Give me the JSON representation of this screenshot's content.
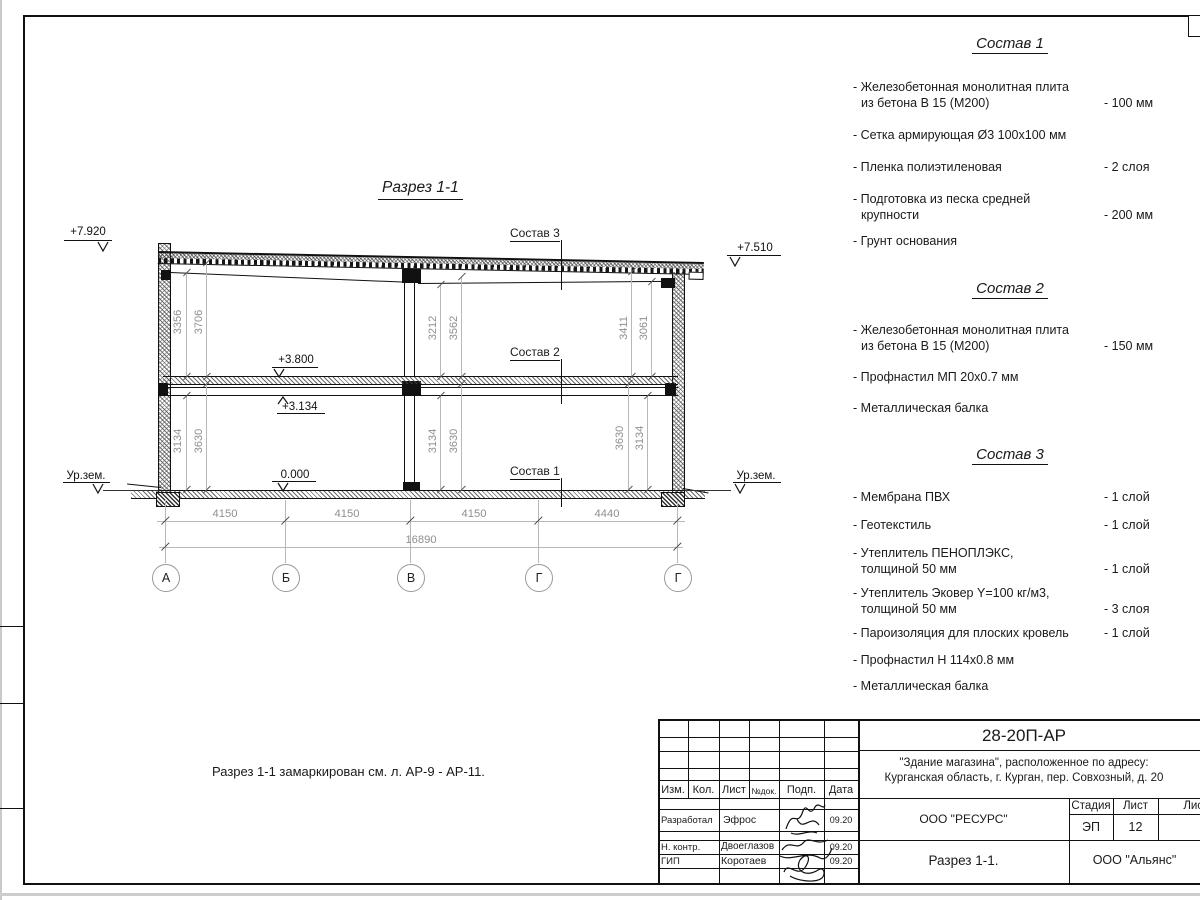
{
  "drawing": {
    "title": "Разрез 1-1",
    "note": "Разрез 1-1 замаркирован см. л. АР-9 - АР-11.",
    "ground_left": "Ур.зем.",
    "ground_right": "Ур.зем.",
    "levels": {
      "roof_left": "+7.920",
      "roof_right": "+7.510",
      "floor2": "+3.800",
      "beam2": "+3.134",
      "floor1": "0.000"
    },
    "callouts": [
      "Состав 3",
      "Состав 2",
      "Состав 1"
    ],
    "axes": [
      "А",
      "Б",
      "В",
      "Г",
      "Г"
    ],
    "dims_bottom": [
      "4150",
      "4150",
      "4150",
      "4440"
    ],
    "dim_total": "16890",
    "vdims": [
      "3356",
      "3706",
      "3212",
      "3562",
      "3411",
      "3061",
      "3134",
      "3630",
      "3134",
      "3630",
      "3630",
      "3134"
    ]
  },
  "specs": [
    {
      "title": "Состав 1",
      "items": [
        {
          "line1": "- Железобетонная  монолитная плита",
          "line2": "из бетона В 15 (М200)",
          "value": "- 100 мм"
        },
        {
          "line1": "- Сетка армирующая Ø3 100x100 мм",
          "line2": "",
          "value": ""
        },
        {
          "line1": "- Пленка полиэтиленовая",
          "line2": "",
          "value": "-  2 слоя"
        },
        {
          "line1": "- Подготовка из песка средней",
          "line2": "крупности",
          "value": "- 200 мм"
        },
        {
          "line1": "- Грунт основания",
          "line2": "",
          "value": ""
        }
      ]
    },
    {
      "title": "Состав 2",
      "items": [
        {
          "line1": "- Железобетонная  монолитная плита",
          "line2": "из бетона В 15 (М200)",
          "value": "- 150 мм"
        },
        {
          "line1": "- Профнастил МП 20x0.7 мм",
          "line2": "",
          "value": ""
        },
        {
          "line1": "- Металлическая балка",
          "line2": "",
          "value": ""
        }
      ]
    },
    {
      "title": "Состав 3",
      "items": [
        {
          "line1": "- Мембрана ПВХ",
          "line2": "",
          "value": "- 1 слой"
        },
        {
          "line1": "- Геотекстиль",
          "line2": "",
          "value": "- 1 слой"
        },
        {
          "line1": "- Утеплитель ПЕНОПЛЭКС,",
          "line2": "толщиной 50 мм",
          "value": "- 1 слой"
        },
        {
          "line1": "- Утеплитель Эковер Y=100 кг/м3,",
          "line2": "толщиной 50 мм",
          "value": "- 3 слоя"
        },
        {
          "line1": "- Пароизоляция для плоских кровель",
          "line2": "",
          "value": "- 1 слой"
        },
        {
          "line1": "- Профнастил Н 114x0.8 мм",
          "line2": "",
          "value": ""
        },
        {
          "line1": "- Металлическая балка",
          "line2": "",
          "value": ""
        }
      ]
    }
  ],
  "titleblock": {
    "doc_code": "28-20П-АР",
    "object_line1": "\"Здание магазина\", расположенное по адресу:",
    "object_line2": "Курганская область, г. Курган, пер. Совхозный, д. 20",
    "org_customer": "ООО \"РЕСУРС\"",
    "org_contractor": "ООО \"Альянс\"",
    "sheet_title": "Разрез 1-1.",
    "stage_label": "Стадия",
    "stage_value": "ЭП",
    "sheet_label": "Лист",
    "sheet_value": "12",
    "sheets_label": "Листов",
    "col_izm": "Изм.",
    "col_kol": "Кол.",
    "col_list": "Лист",
    "col_ndoc": "№док.",
    "col_podp": "Подп.",
    "col_data": "Дата",
    "role1": "Разработал",
    "name1": "Эфрос",
    "date1": "09.20",
    "role2": "Н. контр.",
    "name2": "Двоеглазов",
    "date2": "09.20",
    "role3": "ГИП",
    "name3": "Коротаев",
    "date3": "09.20"
  }
}
